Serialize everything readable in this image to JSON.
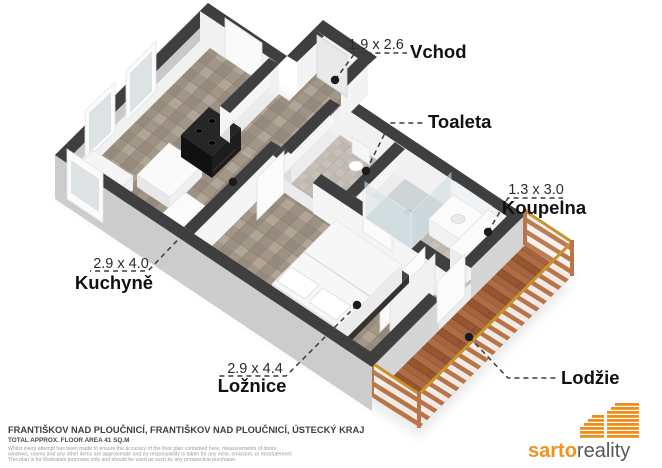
{
  "plan": {
    "labels": {
      "vchod": {
        "dim": "1.9 x 2.6",
        "name": "Vchod"
      },
      "toaleta": {
        "name": "Toaleta"
      },
      "koupelna": {
        "dim": "1.3 x 3.0",
        "name": "Koupelna"
      },
      "kuchyne": {
        "dim": "2.9 x 4.0",
        "name": "Kuchyně"
      },
      "loznice": {
        "dim": "2.9 x 4.4",
        "name": "Ložnice"
      },
      "lodzie": {
        "name": "Lodžie"
      }
    },
    "colors": {
      "wall_cap": "#3f3f3f",
      "wall_face": "#c9c9c9",
      "tile_floor": "#a89c8f",
      "bath_floor": "#c7c1b9",
      "wood_floor": "#a5633e",
      "railing_stripe": "#b9764a",
      "handrail": "#c8922d",
      "marker": "#1b1b1b"
    }
  },
  "footer": {
    "address_line": "FRANTIŠKOV NAD PLOUČNICÍ, FRANTIŠKOV NAD PLOUČNICÍ, ÚSTECKÝ KRAJ",
    "area_line": "TOTAL APPROX. FLOOR AREA 41 SQ.M",
    "disclaimer": [
      "Whilst every attempt has been made to ensure the accuracy of the floor plan contained here, measurements of doors,",
      "windows, rooms and any other items are approximate and no responsibility is taken for any error, omission, or misstatement.",
      "This plan is for illustrative purposes only and should be used as such by any prospective purchaser."
    ]
  },
  "logo": {
    "brand_prefix": "sarto",
    "brand_suffix": "reality",
    "accent": "#F0931B",
    "suffix_color": "#58585B"
  }
}
